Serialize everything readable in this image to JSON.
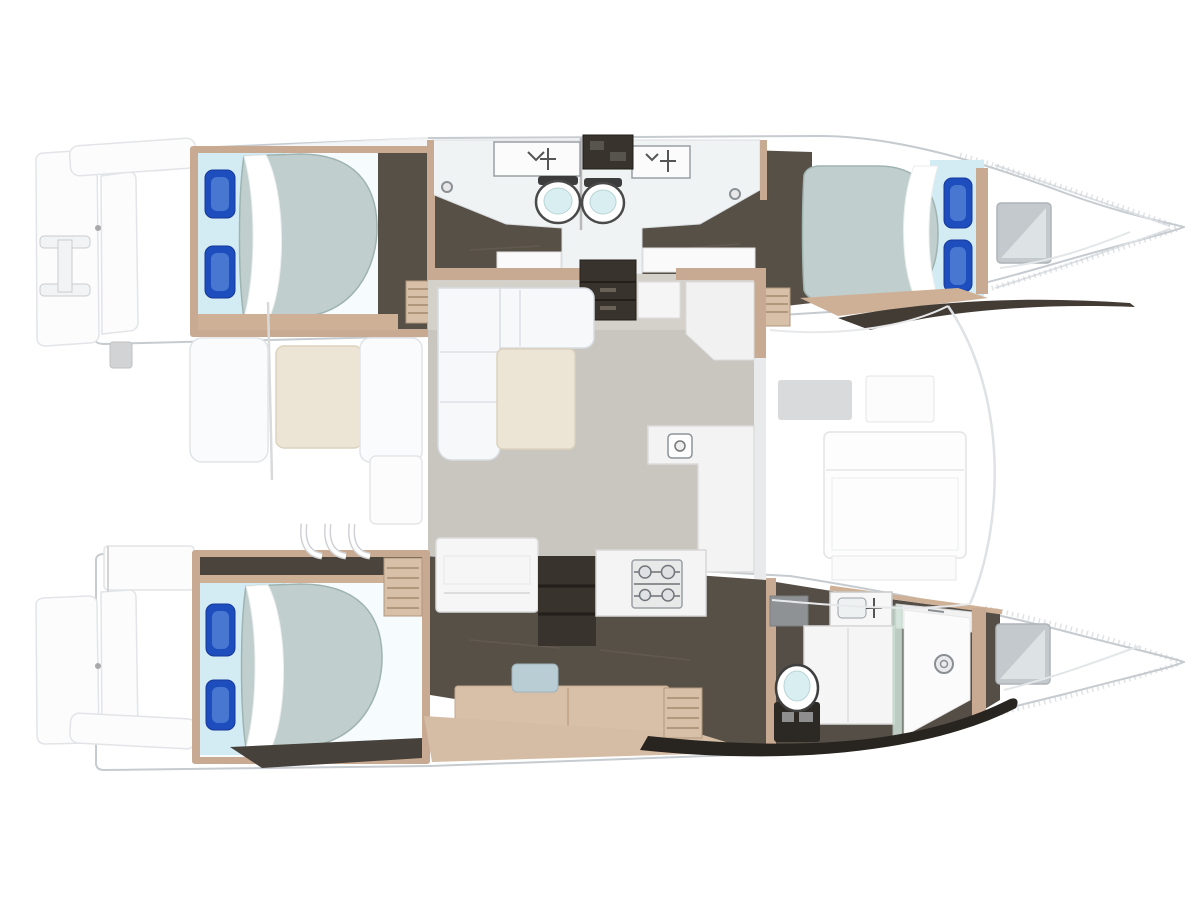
{
  "meta": {
    "kind": "catamaran-yacht-floorplan-top-view",
    "orientation": "bows-pointing-right",
    "visible_text": []
  },
  "palette": {
    "white": "#ffffff",
    "white-soft": "#f4f5f5",
    "stroke-soft": "#dcdcdc",
    "hull-stroke": "#c6cbd0",
    "hull-inner": "#dfe3e6",
    "deck-light": "#f2f3f4",
    "dark-wood": "#575047",
    "dark-wood-2": "#4a443c",
    "near-black": "#2c2823",
    "charcoal": "#38332d",
    "tan": "#c8aa92",
    "tan-light": "#d8c0a8",
    "tan-floor": "#d5bca4",
    "tan-rung": "#b1977c",
    "mattress": "#c0cfcd",
    "mattress-stroke": "#9fb3b1",
    "sheet": "#d3ecf4",
    "pillow": "#1e4dbd",
    "pillow-dark": "#16399a",
    "pillow-hi": "#4f7fd4",
    "salon-floor": "#c9c5bf",
    "salon-floor-light": "#d8d5cf",
    "sofa": "#f7f8fa",
    "sofa-stroke": "#d7dbe0",
    "cream": "#ece5d6",
    "cream-stroke": "#dcd2bd",
    "panel-gray": "#d9dadb",
    "steel-gray": "#8f9294",
    "glass": "#cfe3d8",
    "toilet-lid": "#d9eef0",
    "fixture-stroke": "#4a4a4a",
    "window-gray": "#c3c9cc",
    "bath-floor": "#eff3f4"
  },
  "vessel": {
    "port_hull": {
      "aft_cabin": {
        "bed": "double-berth",
        "pillows": 2
      },
      "bathrooms": [
        "port-aft-bathroom",
        "port-forward-bathroom"
      ],
      "fixtures": [
        "sink-counter-aft",
        "sink-counter-forward",
        "toilet-aft",
        "toilet-forward",
        "deck-hatch"
      ],
      "forward_cabin": {
        "bed": "double-berth",
        "pillows": 2
      },
      "bow": [
        "storage-locker-window",
        "anchor-locker"
      ]
    },
    "starboard_hull": {
      "aft_cabin": {
        "bed": "double-berth",
        "pillows": 2
      },
      "amidships": [
        "vanity-desk",
        "seat-stool",
        "companionway-steps"
      ],
      "forward_bathroom": [
        "vanity-sink",
        "counter-sink",
        "toilet",
        "glass-shower",
        "shower-drain"
      ],
      "bow": [
        "storage-locker-window",
        "anchor-locker"
      ]
    },
    "bridge_deck": {
      "salon": [
        "l-shaped-sofa",
        "coffee-table",
        "nav-cabinet",
        "upper-galley-counter",
        "l-galley-counter",
        "galley-sink",
        "stove-4-burner",
        "bench-cabinet",
        "shelf-unit"
      ],
      "aft_cockpit": [
        "bench-seat-left",
        "cockpit-table",
        "bench-seat-right",
        "helm-box",
        "cockpit-steps"
      ],
      "foredeck": [
        "lounge-panel",
        "deck-pads"
      ]
    },
    "stern": [
      "port-swim-platform",
      "boarding-ladder",
      "starboard-swim-platform",
      "transom-bars"
    ],
    "counts": {
      "berths": 3,
      "toilets": 3,
      "sinks": 5,
      "showers": 1
    }
  }
}
